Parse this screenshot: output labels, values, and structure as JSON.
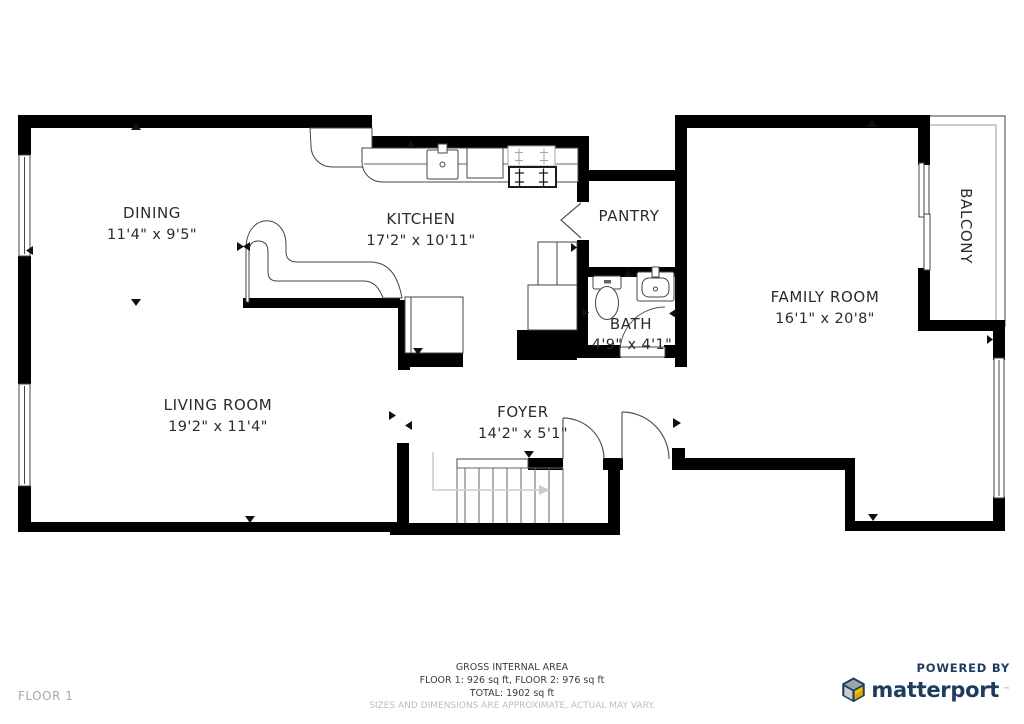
{
  "rooms": [
    {
      "name": "DINING",
      "dims": "11'4\" x 9'5\""
    },
    {
      "name": "KITCHEN",
      "dims": "17'2\" x 10'11\""
    },
    {
      "name": "PANTRY",
      "dims": ""
    },
    {
      "name": "FAMILY ROOM",
      "dims": "16'1\" x 20'8\""
    },
    {
      "name": "BATH",
      "dims": "4'9\" x 4'1\""
    },
    {
      "name": "LIVING ROOM",
      "dims": "19'2\" x 11'4\""
    },
    {
      "name": "FOYER",
      "dims": "14'2\" x 5'1\""
    },
    {
      "name": "BALCONY",
      "dims": ""
    }
  ],
  "footer": {
    "gross_area_title": "GROSS INTERNAL AREA",
    "floors_line": "FLOOR 1: 926 sq ft, FLOOR 2: 976 sq ft",
    "total_line": "TOTAL: 1902 sq ft",
    "disclaimer": "SIZES AND DIMENSIONS ARE APPROXIMATE, ACTUAL MAY VARY.",
    "floor_label": "FLOOR 1"
  },
  "branding": {
    "powered_by": "POWERED BY",
    "brand_name": "matterport",
    "trademark": "™",
    "brand_color": "#1E3C5F",
    "cube_yellow": "#F2C200",
    "cube_gray": "#9BA3AA",
    "wall_color": "#000000"
  }
}
